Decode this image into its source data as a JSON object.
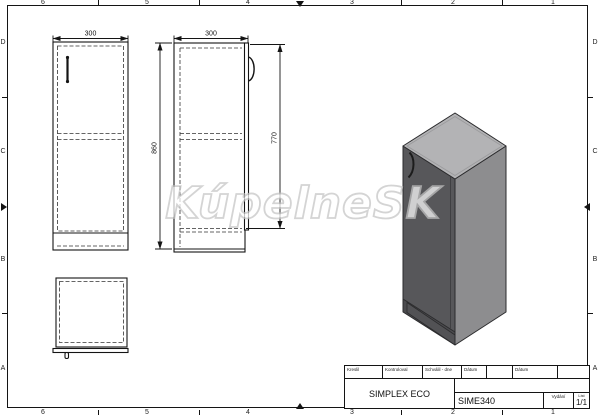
{
  "drawing": {
    "watermark": "KúpelneSK",
    "grid": {
      "cols": [
        "6",
        "5",
        "4",
        "3",
        "2",
        "1"
      ],
      "rows": [
        "D",
        "C",
        "B",
        "A"
      ]
    },
    "dimensions": {
      "front_width": "300",
      "side_depth": "300",
      "total_height": "860",
      "door_height": "770"
    },
    "title_block": {
      "drawn_label": "Kreslil",
      "checked_label": "Kontroloval",
      "approved_label": "Schválil - dne",
      "date_label_1": "Dátum",
      "date_label_2": "Dátum",
      "product_name": "SIMPLEX ECO",
      "product_code": "SIME340",
      "edition_label": "Vydání",
      "sheet_label": "List",
      "sheet_value": "1/1"
    },
    "colors": {
      "iso_top": "#b3b3b5",
      "iso_front": "#57575a",
      "iso_side": "#8d8d8f",
      "iso_plinth": "#4b4b4e"
    }
  }
}
